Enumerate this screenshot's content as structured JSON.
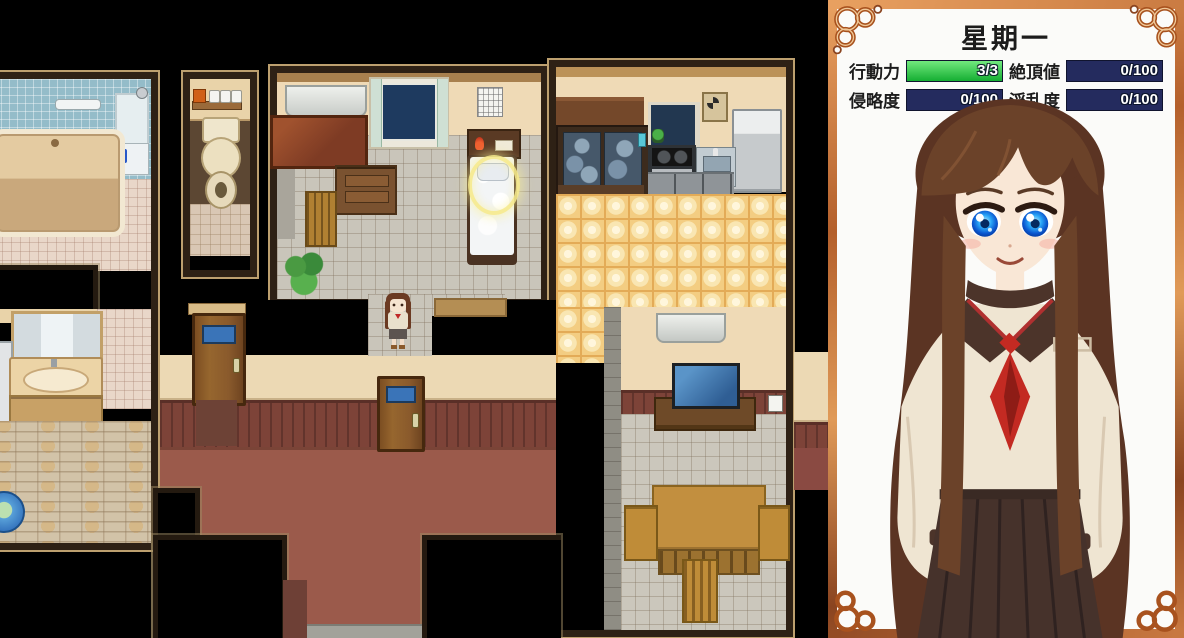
{
  "panel": {
    "title": "星期一",
    "stats": [
      {
        "id": "action-points",
        "label": "行動力",
        "value": "3/3",
        "fill": 100,
        "fill_top": "#72e97e",
        "fill_bottom": "#15ae32"
      },
      {
        "id": "climax-value",
        "label": "絶頂値",
        "value": "0/100",
        "fill": 0,
        "fill_top": "#2a3268",
        "fill_bottom": "#1c2250"
      },
      {
        "id": "aggression",
        "label": "侵略度",
        "value": "0/100",
        "fill": 0,
        "fill_top": "#2a3268",
        "fill_bottom": "#1c2250"
      },
      {
        "id": "lewdness",
        "label": "淫乱度",
        "value": "0/100",
        "fill": 0,
        "fill_top": "#2a3268",
        "fill_bottom": "#1c2250"
      }
    ],
    "portrait": {
      "description": "girl with long brown hair, large blue eyes, sailor school uniform with red necktie and dark brown pleated skirt",
      "hair_color": "#5b3423",
      "skin_color": "#f9e7d6",
      "eye_color": "#1f8df0",
      "uniform_top": "#efe5d2",
      "collar_color": "#4c342a",
      "tie_color": "#c32a22",
      "skirt_color": "#46322b"
    }
  },
  "map": {
    "rooms": [
      "bathroom",
      "washroom",
      "toilet",
      "bedroom",
      "kitchen",
      "living-room",
      "hallway"
    ],
    "player": {
      "location": "bedroom-doorway",
      "facing": "down"
    },
    "highlight": "bed-pillow-glow-ring"
  },
  "colors": {
    "map_background": "#000000",
    "room_border": "#2e2115",
    "room_edge": "#bda06f",
    "bath_wall_tile": "#94bcc9",
    "bath_floor_tile": "#e9d7c9",
    "bathtub": "#d9bd93",
    "bathtub_rim": "#f2e8d2",
    "toilet_wall": "#e9d3a9",
    "toilet_floor": "#5c4733",
    "toilet_tile": "#d9c7b4",
    "bedroom_wall": "#efdab6",
    "bedroom_floor": "#c9c5ba",
    "kitchen_floor": "#f3cd82",
    "living_floor": "#cbc7bc",
    "hall_floor": "#9b5a4b",
    "hall_wall": "#ecd9b4",
    "wainscot": "#7d4338",
    "door_wood": "#8a5a2c",
    "door_window": "#3a74b8",
    "genkan": "#a2a29a",
    "furniture_wood": "#7a5230",
    "desk_wood": "#7e3b24",
    "table_wood": "#c28f3f",
    "window_night": "#1e3a5f",
    "glow": "#f4e88a",
    "panel_bg": "#fbfbf9",
    "bar_track": "#242b5e",
    "ui_text": "#1c1c1c",
    "frame_light": "#e8a060",
    "frame_dark": "#8a4420"
  }
}
